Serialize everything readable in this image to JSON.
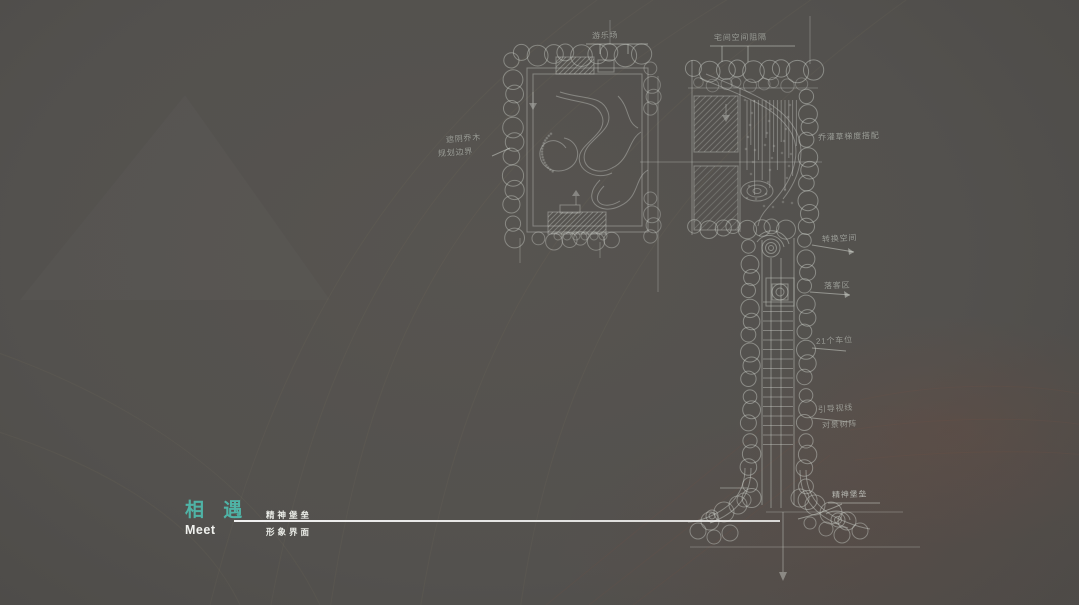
{
  "slide": {
    "title_cn": "相 遇",
    "title_en": "Meet",
    "subtitle_top": "精神堡垒",
    "subtitle_bottom": "形象界面"
  },
  "sketch_annotations": {
    "play_area": "游乐场",
    "space_separation": "宅间空间阻隔",
    "left_note_1": "遮阴乔木",
    "left_note_2": "规划边界",
    "planting_mix": "乔灌草梯度搭配",
    "transition_space": "转换空间",
    "drop_off": "落客区",
    "parking": "21个车位",
    "view_guide": "引导视线",
    "feature_trees": "对景树阵",
    "spirit_fortress": "精神堡垒"
  },
  "colors": {
    "background": "#53514e",
    "accent_teal": "#4fb3a6",
    "sketch_line": "#cfd3cc",
    "text_white": "#f0f1ee",
    "warm_patch": "#7a4634"
  }
}
